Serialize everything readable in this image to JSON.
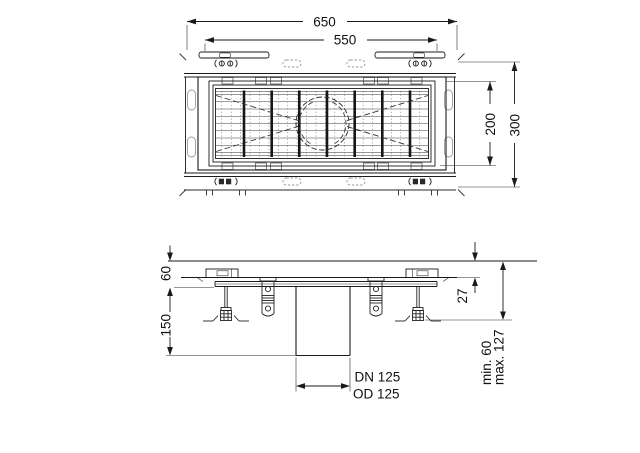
{
  "drawing": {
    "plan": {
      "dim_overall_width": "650",
      "dim_grate_width": "550",
      "dim_channel_width": "200",
      "dim_overall_depth": "300"
    },
    "section": {
      "dim_edge_height": "60",
      "dim_body_height": "150",
      "dim_recess": "27",
      "dim_install_min": "min. 60",
      "dim_install_max": "max. 127",
      "outlet_label_line1": "DN 125",
      "outlet_label_line2": "OD 125"
    },
    "colors": {
      "line": "#1a1a1a",
      "thin_line": "#3c3c3c",
      "light_line": "#9b9b9b",
      "background": "#ffffff"
    }
  }
}
